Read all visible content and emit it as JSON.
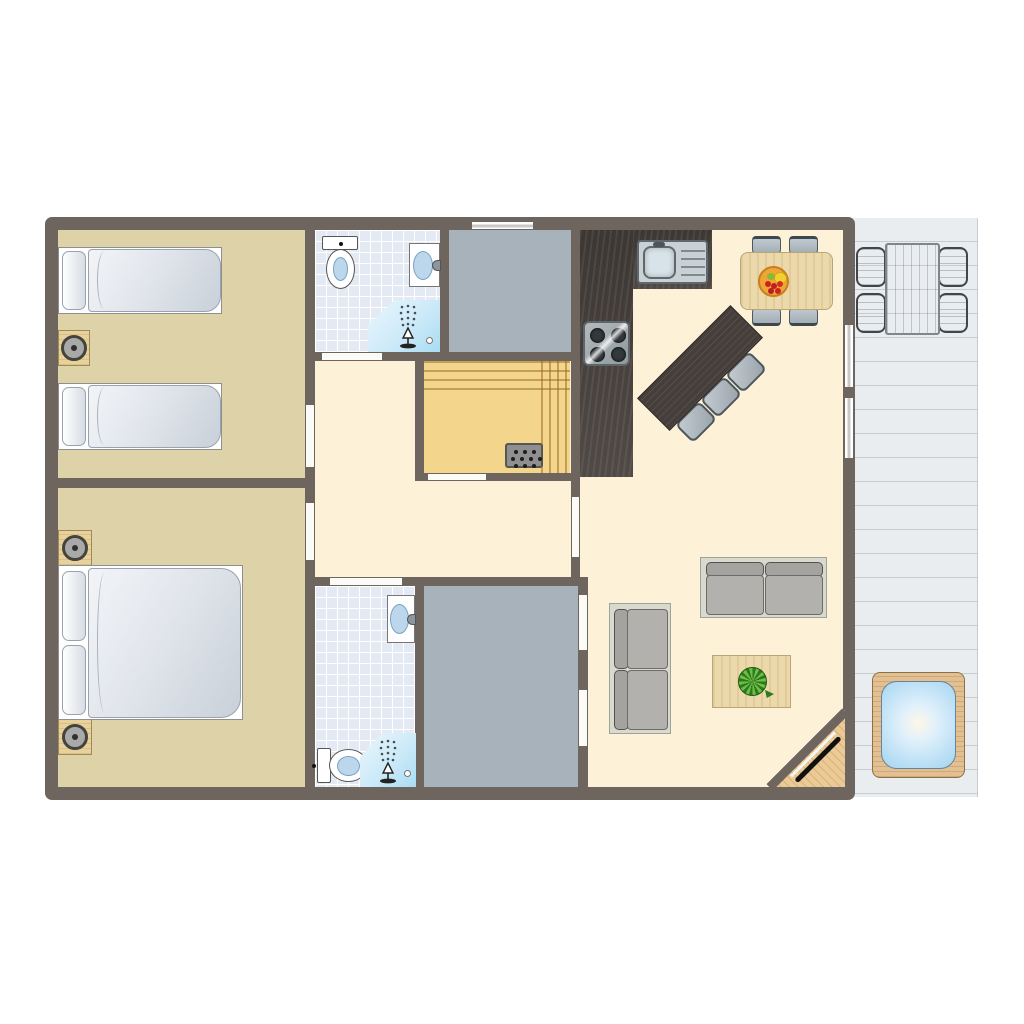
{
  "app": {
    "title": "Holiday home floor plan"
  },
  "colors": {
    "wall": "#6e655f",
    "bedroom-floor": "#ded2a9",
    "living-floor": "#fdf2d7",
    "bath-floor": "#e4eaf3",
    "gray-room": "#a8b2ba",
    "sauna-floor": "#f3d58c",
    "terrace": "#eaedf0",
    "terrace-line": "#c6ccd2",
    "counter": "#47403c",
    "wood-light": "#ecd9ab",
    "sofa-frame": "#d8dacf",
    "cushion": "#b3b1ae",
    "fruit-orange": "#f0a636"
  },
  "rooms": {
    "bedroom_twin": {
      "label": "Bedroom with two single beds and nightstand"
    },
    "bedroom_double": {
      "label": "Bedroom with double bed and two nightstands"
    },
    "bathroom_top": {
      "label": "Bathroom with toilet, washbasin and corner shower"
    },
    "bathroom_bottom": {
      "label": "Bathroom with washbasin, toilet and corner shower"
    },
    "sauna": {
      "label": "Sauna with benches and heater"
    },
    "hall": {
      "label": "Hallway"
    },
    "kitchen": {
      "label": "Kitchen with sink, hob, bar and dining table"
    },
    "living": {
      "label": "Living room with two sofas and coffee table"
    },
    "storage_top": {
      "label": "Storage room"
    },
    "storage_bottom": {
      "label": "Storage room"
    },
    "terrace": {
      "label": "Terrace with outdoor dining set and hot tub"
    },
    "entrance": {
      "label": "Corner entrance door"
    }
  },
  "furniture": {
    "single_bed": "single bed",
    "double_bed": "double bed",
    "nightstand_lamp": "nightstand with lamp",
    "toilet": "toilet",
    "washbasin": "washbasin",
    "shower": "shower",
    "sauna_heater": "sauna heater",
    "kitchen_sink": "kitchen sink with drainboard",
    "hob": "4-burner hob",
    "dining_table": "dining table with fruit bowl and four chairs",
    "bar": "bar table with three stools",
    "sofa": "two-seat sofa",
    "coffee_table": "coffee table with plant",
    "outdoor_set": "outdoor table with four chairs",
    "hot_tub": "hot tub"
  }
}
